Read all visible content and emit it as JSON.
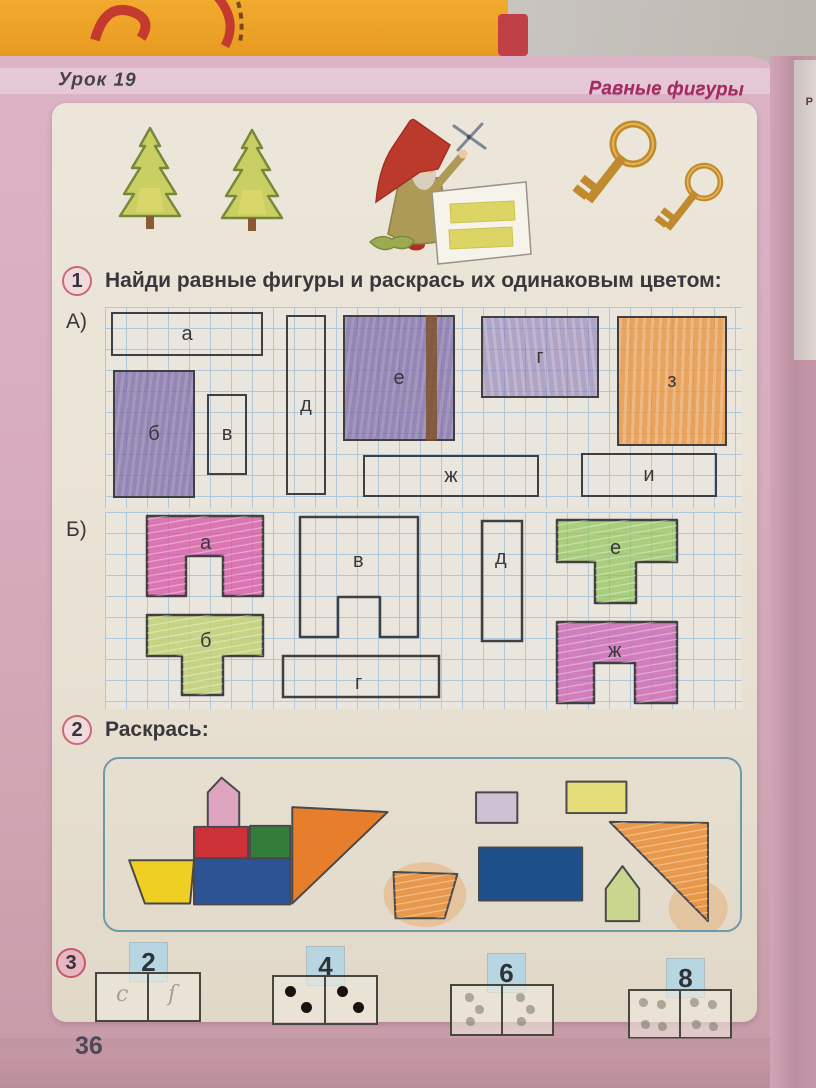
{
  "header": {
    "lesson": "Урок 19",
    "topic": "Равные фигуры",
    "neighbor_page_text": "Р"
  },
  "tasks": {
    "t1": {
      "number": "1",
      "text": "Найди равные фигуры и раскрась их одинаковым цветом:"
    },
    "t2": {
      "number": "2",
      "text": "Раскрась:"
    },
    "t3": {
      "number": "3"
    }
  },
  "section_a": {
    "label": "А)",
    "shapes": [
      {
        "label": "а",
        "fill": "none"
      },
      {
        "label": "б",
        "fill": "purple"
      },
      {
        "label": "в",
        "fill": "none"
      },
      {
        "label": "д",
        "fill": "none"
      },
      {
        "label": "е",
        "fill": "purple-with-brown-stripe"
      },
      {
        "label": "г",
        "fill": "purple-light"
      },
      {
        "label": "з",
        "fill": "orange"
      },
      {
        "label": "ж",
        "fill": "none"
      },
      {
        "label": "и",
        "fill": "none"
      }
    ]
  },
  "section_b": {
    "label": "Б)",
    "shapes": [
      {
        "label": "а",
        "fill": "pink"
      },
      {
        "label": "б",
        "fill": "yellow-green"
      },
      {
        "label": "в",
        "fill": "none"
      },
      {
        "label": "г",
        "fill": "none"
      },
      {
        "label": "д",
        "fill": "none"
      },
      {
        "label": "е",
        "fill": "green"
      },
      {
        "label": "ж",
        "fill": "magenta"
      }
    ]
  },
  "task3": {
    "items": [
      {
        "label": "2",
        "left_dots": 1,
        "right_dots": 1,
        "style": "pencil",
        "pencil_marks": [
          "c",
          "ſ"
        ]
      },
      {
        "label": "4",
        "left_dots": 2,
        "right_dots": 2,
        "style": "printed"
      },
      {
        "label": "6",
        "left_dots": 3,
        "right_dots": 3,
        "style": "pencil"
      },
      {
        "label": "8",
        "left_dots": 4,
        "right_dots": 4,
        "style": "pencil"
      }
    ]
  },
  "page_number": "36",
  "illustration": {
    "items": [
      "fir-tree",
      "fir-tree",
      "gnome-cutting-paper",
      "key",
      "key"
    ]
  },
  "colors": {
    "topic_text": "#a62a62",
    "grid_line": "#afc8da",
    "outline": "#403f41",
    "crayon_purple": "#8c7cb2",
    "crayon_orange": "#e8923c",
    "crayon_pink": "#d750a4",
    "crayon_yellow_green": "#bed06e",
    "crayon_green": "#8fc352",
    "crayon_magenta": "#c964b4",
    "ship_yellow": "#f0cf25",
    "ship_red": "#cd3138",
    "ship_green": "#337d3a",
    "ship_blue": "#2e5394",
    "ship_pink": "#dfa5c0",
    "ship_orange": "#e67e2b",
    "colored_lilac": "#c9bdd3",
    "colored_yellow": "#e4dd6a",
    "solid_navy": "#1d4f8a",
    "colored_light_green": "#c6d584",
    "colored_orange": "#e8913d",
    "label_bg": "#b7d6e2",
    "box_border": "#6f9aaa",
    "key_gold": "#c08a2e"
  }
}
